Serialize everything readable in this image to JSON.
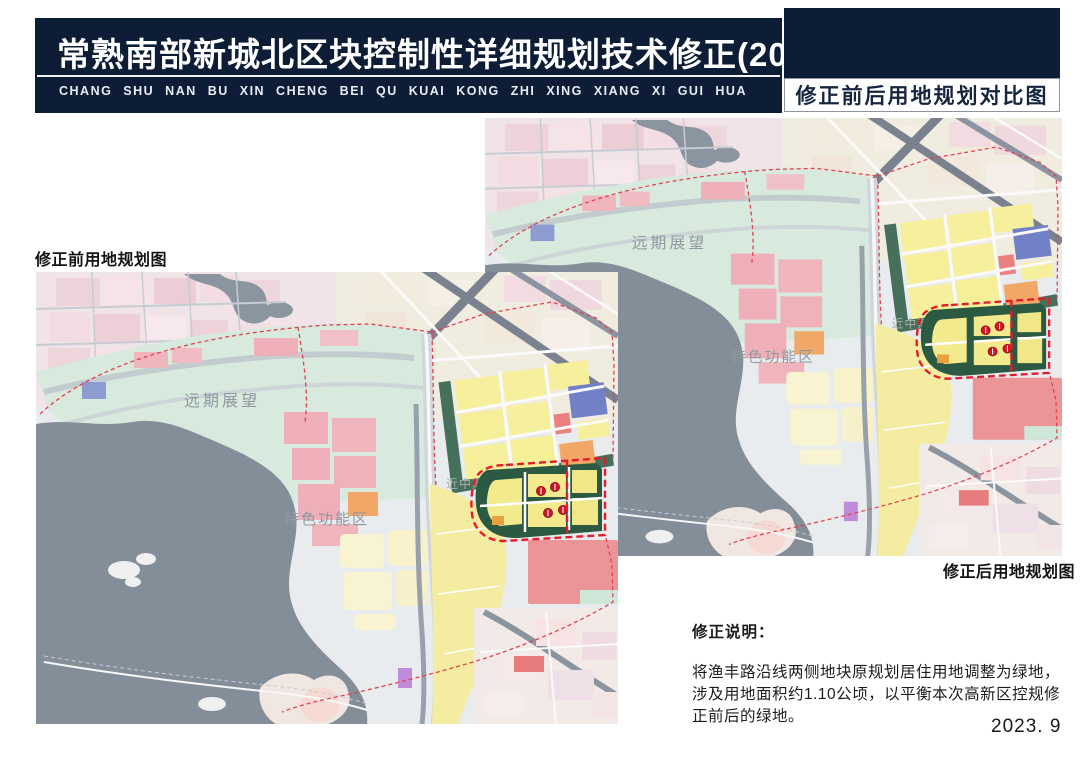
{
  "page": {
    "background": "#ffffff",
    "date": "2023. 9"
  },
  "header": {
    "bar_color": "#0d1d36",
    "title": "常熟南部新城北区块控制性详细规划技术修正(2023年)",
    "subtitle": "CHANG SHU NAN BU XIN CHENG BEI QU KUAI KONG ZHI XING XIANG XI GUI HUA",
    "corner_tag": "修正前后用地规划对比图"
  },
  "maps": {
    "before_label": "修正前用地规划图",
    "after_label": "修正后用地规划图",
    "area_labels": {
      "longterm": "远期展望",
      "special_zone": "特色功能区",
      "near_mid_term": "近中期"
    }
  },
  "note": {
    "heading": "修正说明：",
    "body": "将渔丰路沿线两侧地块原规划居住用地调整为绿地，涉及用地面积约1.10公顷，以平衡本次高新区控规修正前后的绿地。"
  },
  "legend_colors": {
    "header_navy": "#0d1d36",
    "residential_yellow": "#f6f09d",
    "pink_block": "#eeafb8",
    "orange_block": "#f1a765",
    "blue_block": "#7280c7",
    "salmon_red": "#ec9598",
    "green_space_dark": "#2c5941",
    "mint_green": "#d8e9de",
    "water_gray": "#848e99",
    "boundary_red_dash": "#e61a2b"
  }
}
